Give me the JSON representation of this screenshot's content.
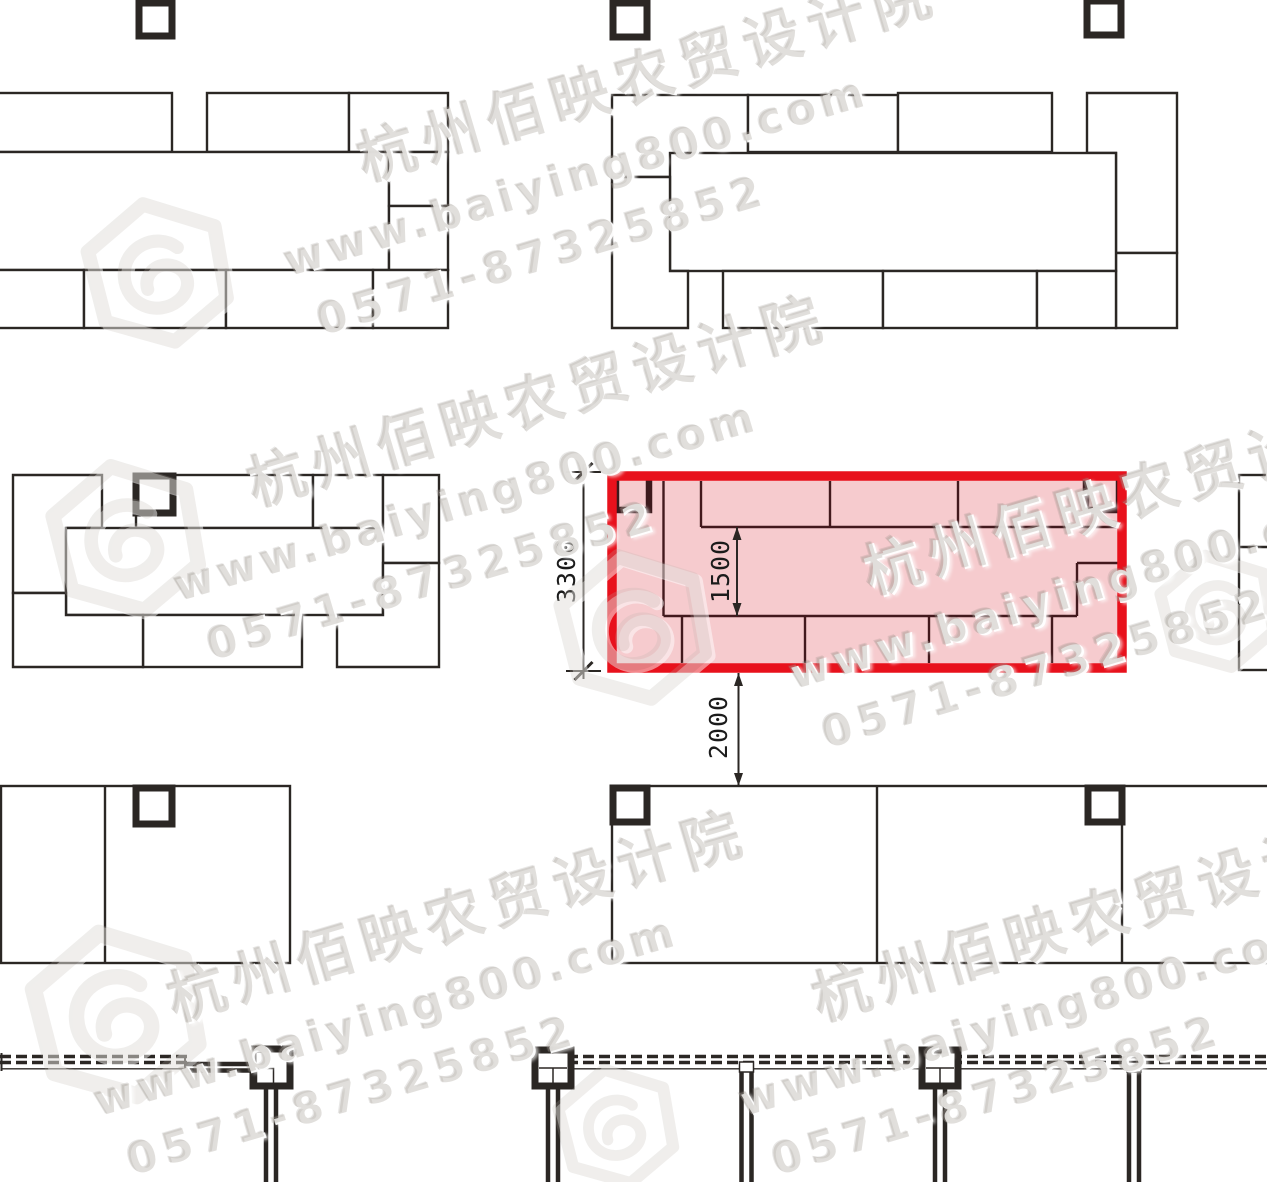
{
  "watermark": {
    "company": "杭州佰映农贸设计院",
    "website": "www.baiying800.com",
    "phone": "0571-87325852"
  },
  "dimensions": {
    "overall_height": "3300",
    "inner_height": "1500",
    "aisle_gap": "2000"
  },
  "colors": {
    "line": "#2b2724",
    "highlight_red": "#e8111c",
    "highlight_fill": "#f6cbce",
    "highlight_line": "#42191d",
    "column_dark": "#3c191c",
    "white": "#ffffff",
    "watermark_gray": "rgba(185,178,171,0.40)"
  },
  "plan": {
    "canvas": {
      "w": 1267,
      "h": 1182
    },
    "stall_clusters": [
      {
        "id": "top-left",
        "shapes": [
          {
            "t": "r",
            "v": [
              -14,
              93,
              186,
              59
            ]
          },
          {
            "t": "r",
            "v": [
              207,
              93,
              142,
              59
            ]
          },
          {
            "t": "r",
            "v": [
              349,
              93,
              99,
              59
            ]
          },
          {
            "t": "r",
            "v": [
              -14,
              152,
              403,
              118
            ]
          },
          {
            "t": "r",
            "v": [
              389,
              152,
              59,
              54
            ]
          },
          {
            "t": "r",
            "v": [
              389,
              206,
              59,
              64
            ]
          },
          {
            "t": "r",
            "v": [
              -14,
              270,
              98,
              58
            ]
          },
          {
            "t": "r",
            "v": [
              84,
              270,
              142,
              58
            ]
          },
          {
            "t": "r",
            "v": [
              226,
              270,
              147,
              58
            ]
          },
          {
            "t": "r",
            "v": [
              373,
              270,
              75,
              58
            ]
          }
        ]
      },
      {
        "id": "top-middle",
        "shapes": [
          {
            "t": "r",
            "v": [
              612,
              95,
              136,
              82
            ]
          },
          {
            "t": "r",
            "v": [
              748,
              95,
              150,
              57
            ]
          },
          {
            "t": "r",
            "v": [
              898,
              93,
              154,
              59
            ]
          },
          {
            "t": "p",
            "v": [
              [
                1087,
                93
              ],
              [
                1177,
                93
              ],
              [
                1177,
                253
              ],
              [
                1116,
                253
              ],
              [
                1116,
                153
              ],
              [
                1087,
                153
              ]
            ]
          },
          {
            "t": "r",
            "v": [
              1116,
              253,
              61,
              75
            ]
          },
          {
            "t": "r",
            "v": [
              670,
              153,
              446,
              118
            ]
          },
          {
            "t": "p",
            "v": [
              [
                612,
                177
              ],
              [
                670,
                177
              ],
              [
                670,
                271
              ],
              [
                688,
                271
              ],
              [
                688,
                328
              ],
              [
                612,
                328
              ]
            ]
          },
          {
            "t": "r",
            "v": [
              723,
              271,
              160,
              57
            ]
          },
          {
            "t": "r",
            "v": [
              883,
              271,
              154,
              57
            ]
          },
          {
            "t": "r",
            "v": [
              1037,
              271,
              79,
              57
            ]
          }
        ]
      },
      {
        "id": "middle-left",
        "shapes": [
          {
            "t": "p",
            "v": [
              [
                13,
                475
              ],
              [
                102,
                475
              ],
              [
                102,
                528
              ],
              [
                66,
                528
              ],
              [
                66,
                593
              ],
              [
                13,
                593
              ]
            ]
          },
          {
            "t": "r",
            "v": [
              136,
              475,
              177,
              53
            ]
          },
          {
            "t": "r",
            "v": [
              313,
              475,
              70,
              53
            ]
          },
          {
            "t": "r",
            "v": [
              383,
              475,
              56,
              88
            ]
          },
          {
            "t": "r",
            "v": [
              66,
              528,
              317,
              87
            ]
          },
          {
            "t": "r",
            "v": [
              143,
              615,
              159,
              52
            ]
          },
          {
            "t": "p",
            "v": [
              [
                13,
                593
              ],
              [
                66,
                593
              ],
              [
                66,
                615
              ],
              [
                143,
                615
              ],
              [
                143,
                667
              ],
              [
                13,
                667
              ]
            ]
          },
          {
            "t": "p",
            "v": [
              [
                337,
                615
              ],
              [
                383,
                615
              ],
              [
                383,
                563
              ],
              [
                439,
                563
              ],
              [
                439,
                667
              ],
              [
                337,
                667
              ]
            ]
          }
        ]
      },
      {
        "id": "right-edge",
        "shapes": [
          {
            "t": "r",
            "v": [
              1239,
              475,
              40,
              195
            ]
          },
          {
            "t": "l",
            "v": [
              1239,
              547,
              1279,
              547
            ]
          }
        ]
      },
      {
        "id": "bottom-left",
        "shapes": [
          {
            "t": "r",
            "v": [
              1,
              786,
              289,
              177
            ]
          },
          {
            "t": "l",
            "v": [
              105,
              786,
              105,
              963
            ]
          }
        ]
      },
      {
        "id": "bottom-middle",
        "shapes": [
          {
            "t": "r",
            "v": [
              612,
              786,
              662,
              177
            ]
          },
          {
            "t": "l",
            "v": [
              877,
              786,
              877,
              963
            ]
          },
          {
            "t": "l",
            "v": [
              1122,
              786,
              1122,
              963
            ]
          }
        ]
      }
    ],
    "columns": [
      {
        "x": 139,
        "y": 3,
        "s": 33
      },
      {
        "x": 613,
        "y": 3,
        "s": 34
      },
      {
        "x": 1087,
        "y": 1,
        "s": 34
      },
      {
        "x": 136,
        "y": 476,
        "s": 37
      },
      {
        "x": 136,
        "y": 788,
        "s": 36
      },
      {
        "x": 613,
        "y": 788,
        "s": 34
      },
      {
        "x": 1088,
        "y": 788,
        "s": 34
      }
    ],
    "highlight": {
      "outer": {
        "x": 612,
        "y": 476,
        "w": 510,
        "h": 192
      },
      "border_width": 9.5,
      "dark_columns": [
        {
          "x": 616,
          "y": 477,
          "s": 33
        },
        {
          "x": 1086,
          "y": 477,
          "s": 33
        }
      ],
      "lines": [
        [
          663.5,
          481,
          663.5,
          616
        ],
        [
          701,
          481,
          701,
          527
        ],
        [
          830,
          481,
          830,
          527
        ],
        [
          958,
          481,
          958,
          527
        ],
        [
          701,
          527,
          1121,
          527
        ],
        [
          663.5,
          616,
          1077,
          616
        ],
        [
          1077,
          563,
          1121,
          563
        ],
        [
          1077,
          563,
          1077,
          616
        ],
        [
          682,
          616,
          682,
          663
        ],
        [
          805,
          616,
          805,
          663
        ],
        [
          929,
          616,
          929,
          663
        ],
        [
          1052,
          616,
          1052,
          663
        ]
      ]
    },
    "dims": [
      {
        "id": "overall-height",
        "x": 583.5,
        "y1": 472,
        "y2": 671,
        "style": "tick",
        "ext": [
          [
            566,
            472,
            601,
            472
          ],
          [
            566,
            671,
            601,
            671
          ]
        ]
      },
      {
        "id": "inner-height",
        "x": 737,
        "y1": 527,
        "y2": 616,
        "style": "arrow",
        "ext": []
      },
      {
        "id": "aisle-gap",
        "x": 738.5,
        "y1": 673,
        "y2": 786,
        "style": "arrow",
        "ext": []
      }
    ],
    "wall": {
      "dash_y": [
        1056.5,
        1062.5
      ],
      "dash_segments": [
        [
          0,
          190
        ],
        [
          535,
          1270
        ]
      ],
      "thin_y": 1068.8,
      "thin_segments": [
        [
          2,
          185
        ],
        [
          553,
          1270
        ]
      ],
      "solid_wall": {
        "x1": 185,
        "x2": 254,
        "rows": [
          1064,
          1070.5
        ]
      },
      "end_ticks": [
        [
          1.5,
          1053,
          1.5,
          1071
        ],
        [
          185,
          1055,
          185,
          1069
        ]
      ],
      "columns": [
        {
          "x": 253,
          "y": 1049,
          "s": 37
        },
        {
          "x": 535,
          "y": 1050,
          "s": 36
        },
        {
          "x": 922,
          "y": 1050,
          "s": 36
        }
      ],
      "column_detail_rects": [
        [
          256.5,
          1068.5,
          17,
          16
        ]
      ],
      "column_detail_lines": [
        [
          539,
          1068,
          567,
          1068
        ],
        [
          553,
          1068,
          553,
          1084
        ],
        [
          926,
          1068,
          954,
          1068
        ],
        [
          940,
          1068,
          940,
          1084
        ]
      ],
      "piers": [
        {
          "cx": 271,
          "y1": 1086,
          "bracket": false
        },
        {
          "cx": 553,
          "y1": 1086,
          "bracket": false
        },
        {
          "cx": 746.5,
          "y1": 1070,
          "bracket": true
        },
        {
          "cx": 940,
          "y1": 1086,
          "bracket": false
        },
        {
          "cx": 1134,
          "y1": 1070,
          "bracket": true
        }
      ],
      "pier_y2": 1184
    },
    "watermark_tiles": [
      {
        "x": 250,
        "y": 145
      },
      {
        "x": 140,
        "y": 470
      },
      {
        "x": 755,
        "y": 558
      },
      {
        "x": 60,
        "y": 985
      },
      {
        "x": 705,
        "y": 985
      }
    ],
    "logos": [
      {
        "x": 85,
        "y": 200,
        "s": 145
      },
      {
        "x": 50,
        "y": 462,
        "s": 152
      },
      {
        "x": 558,
        "y": 552,
        "s": 150
      },
      {
        "x": 30,
        "y": 928,
        "s": 172
      },
      {
        "x": 1158,
        "y": 552,
        "s": 118
      },
      {
        "x": 556,
        "y": 1066,
        "s": 120
      }
    ]
  }
}
